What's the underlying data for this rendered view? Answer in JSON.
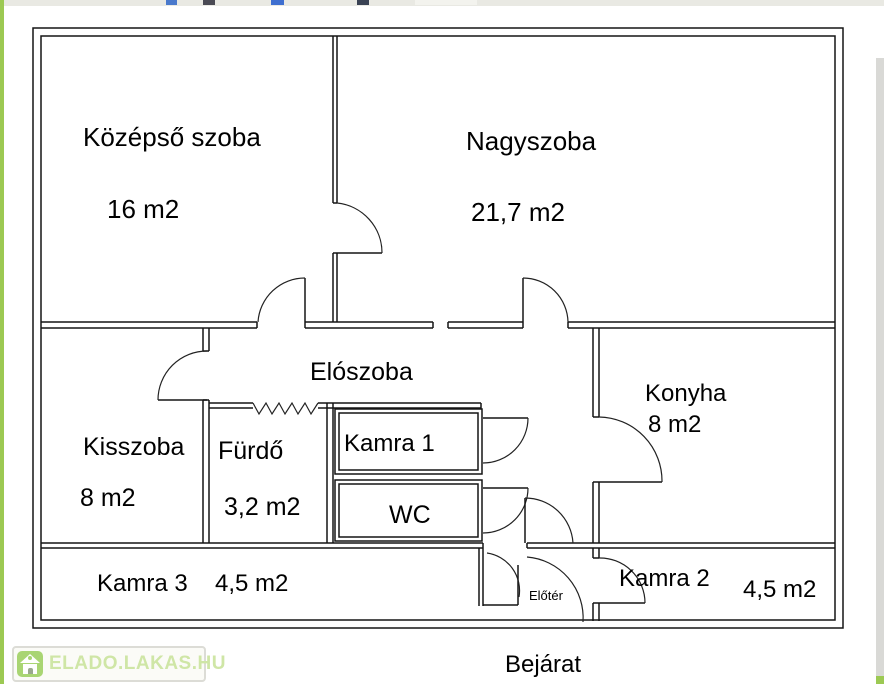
{
  "watermark": {
    "text": "ELADO.LAKAS.HU",
    "icon": "house-icon"
  },
  "entrance_label": "Bejárat",
  "rooms": {
    "kozepso": {
      "name": "Középső szoba",
      "area": "16 m2"
    },
    "nagyszoba": {
      "name": "Nagyszoba",
      "area": "21,7 m2"
    },
    "eloszoba": {
      "name": "Elószoba"
    },
    "kisszoba": {
      "name": "Kisszoba",
      "area": "8 m2"
    },
    "furdo": {
      "name": "Fürdő",
      "area": "3,2 m2"
    },
    "kamra1": {
      "name": "Kamra 1"
    },
    "wc": {
      "name": "WC"
    },
    "konyha": {
      "name": "Konyha",
      "area": "8 m2"
    },
    "kamra3": {
      "name": "Kamra 3",
      "area": "4,5 m2"
    },
    "eloter": {
      "name": "Előtér"
    },
    "kamra2": {
      "name": "Kamra 2",
      "area": "4,5 m2"
    }
  },
  "colors": {
    "accent_green": "#9cc953",
    "wall": "#151515",
    "watermark_green": "#cfe6a6"
  }
}
